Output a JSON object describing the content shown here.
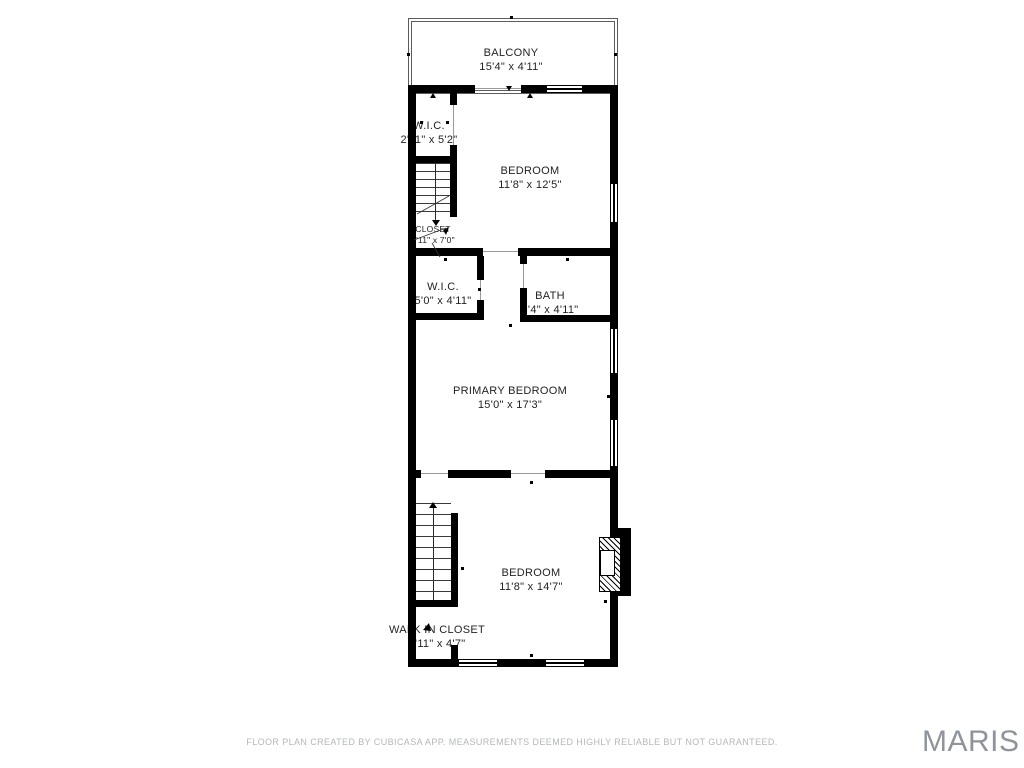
{
  "rooms": [
    {
      "name": "BALCONY",
      "dims": "15'4\" x 4'11\""
    },
    {
      "name": "W.I.C.",
      "dims": "2'11\" x 5'2\""
    },
    {
      "name": "BEDROOM",
      "dims": "11'8\" x 12'5\""
    },
    {
      "name": "CLOSET",
      "dims": "2'11\" x 7'0\""
    },
    {
      "name": "W.I.C.",
      "dims": "5'0\" x 4'11\""
    },
    {
      "name": "BATH",
      "dims": "6'4\" x 4'11\""
    },
    {
      "name": "PRIMARY BEDROOM",
      "dims": "15'0\" x 17'3\""
    },
    {
      "name": "BEDROOM",
      "dims": "11'8\" x 14'7\""
    },
    {
      "name": "WALK IN CLOSET",
      "dims": "2'11\" x 4'7\""
    }
  ],
  "footer": {
    "disclaimer": "FLOOR PLAN CREATED BY CUBICASA APP. MEASUREMENTS DEEMED HIGHLY RELIABLE BUT NOT GUARANTEED."
  },
  "branding": {
    "logo": "MARIS"
  },
  "colors": {
    "wall": "#000000",
    "background": "#ffffff",
    "label": "#232323",
    "disclaimer_text": "#b4b7b9",
    "logo_text": "#8f949c"
  }
}
